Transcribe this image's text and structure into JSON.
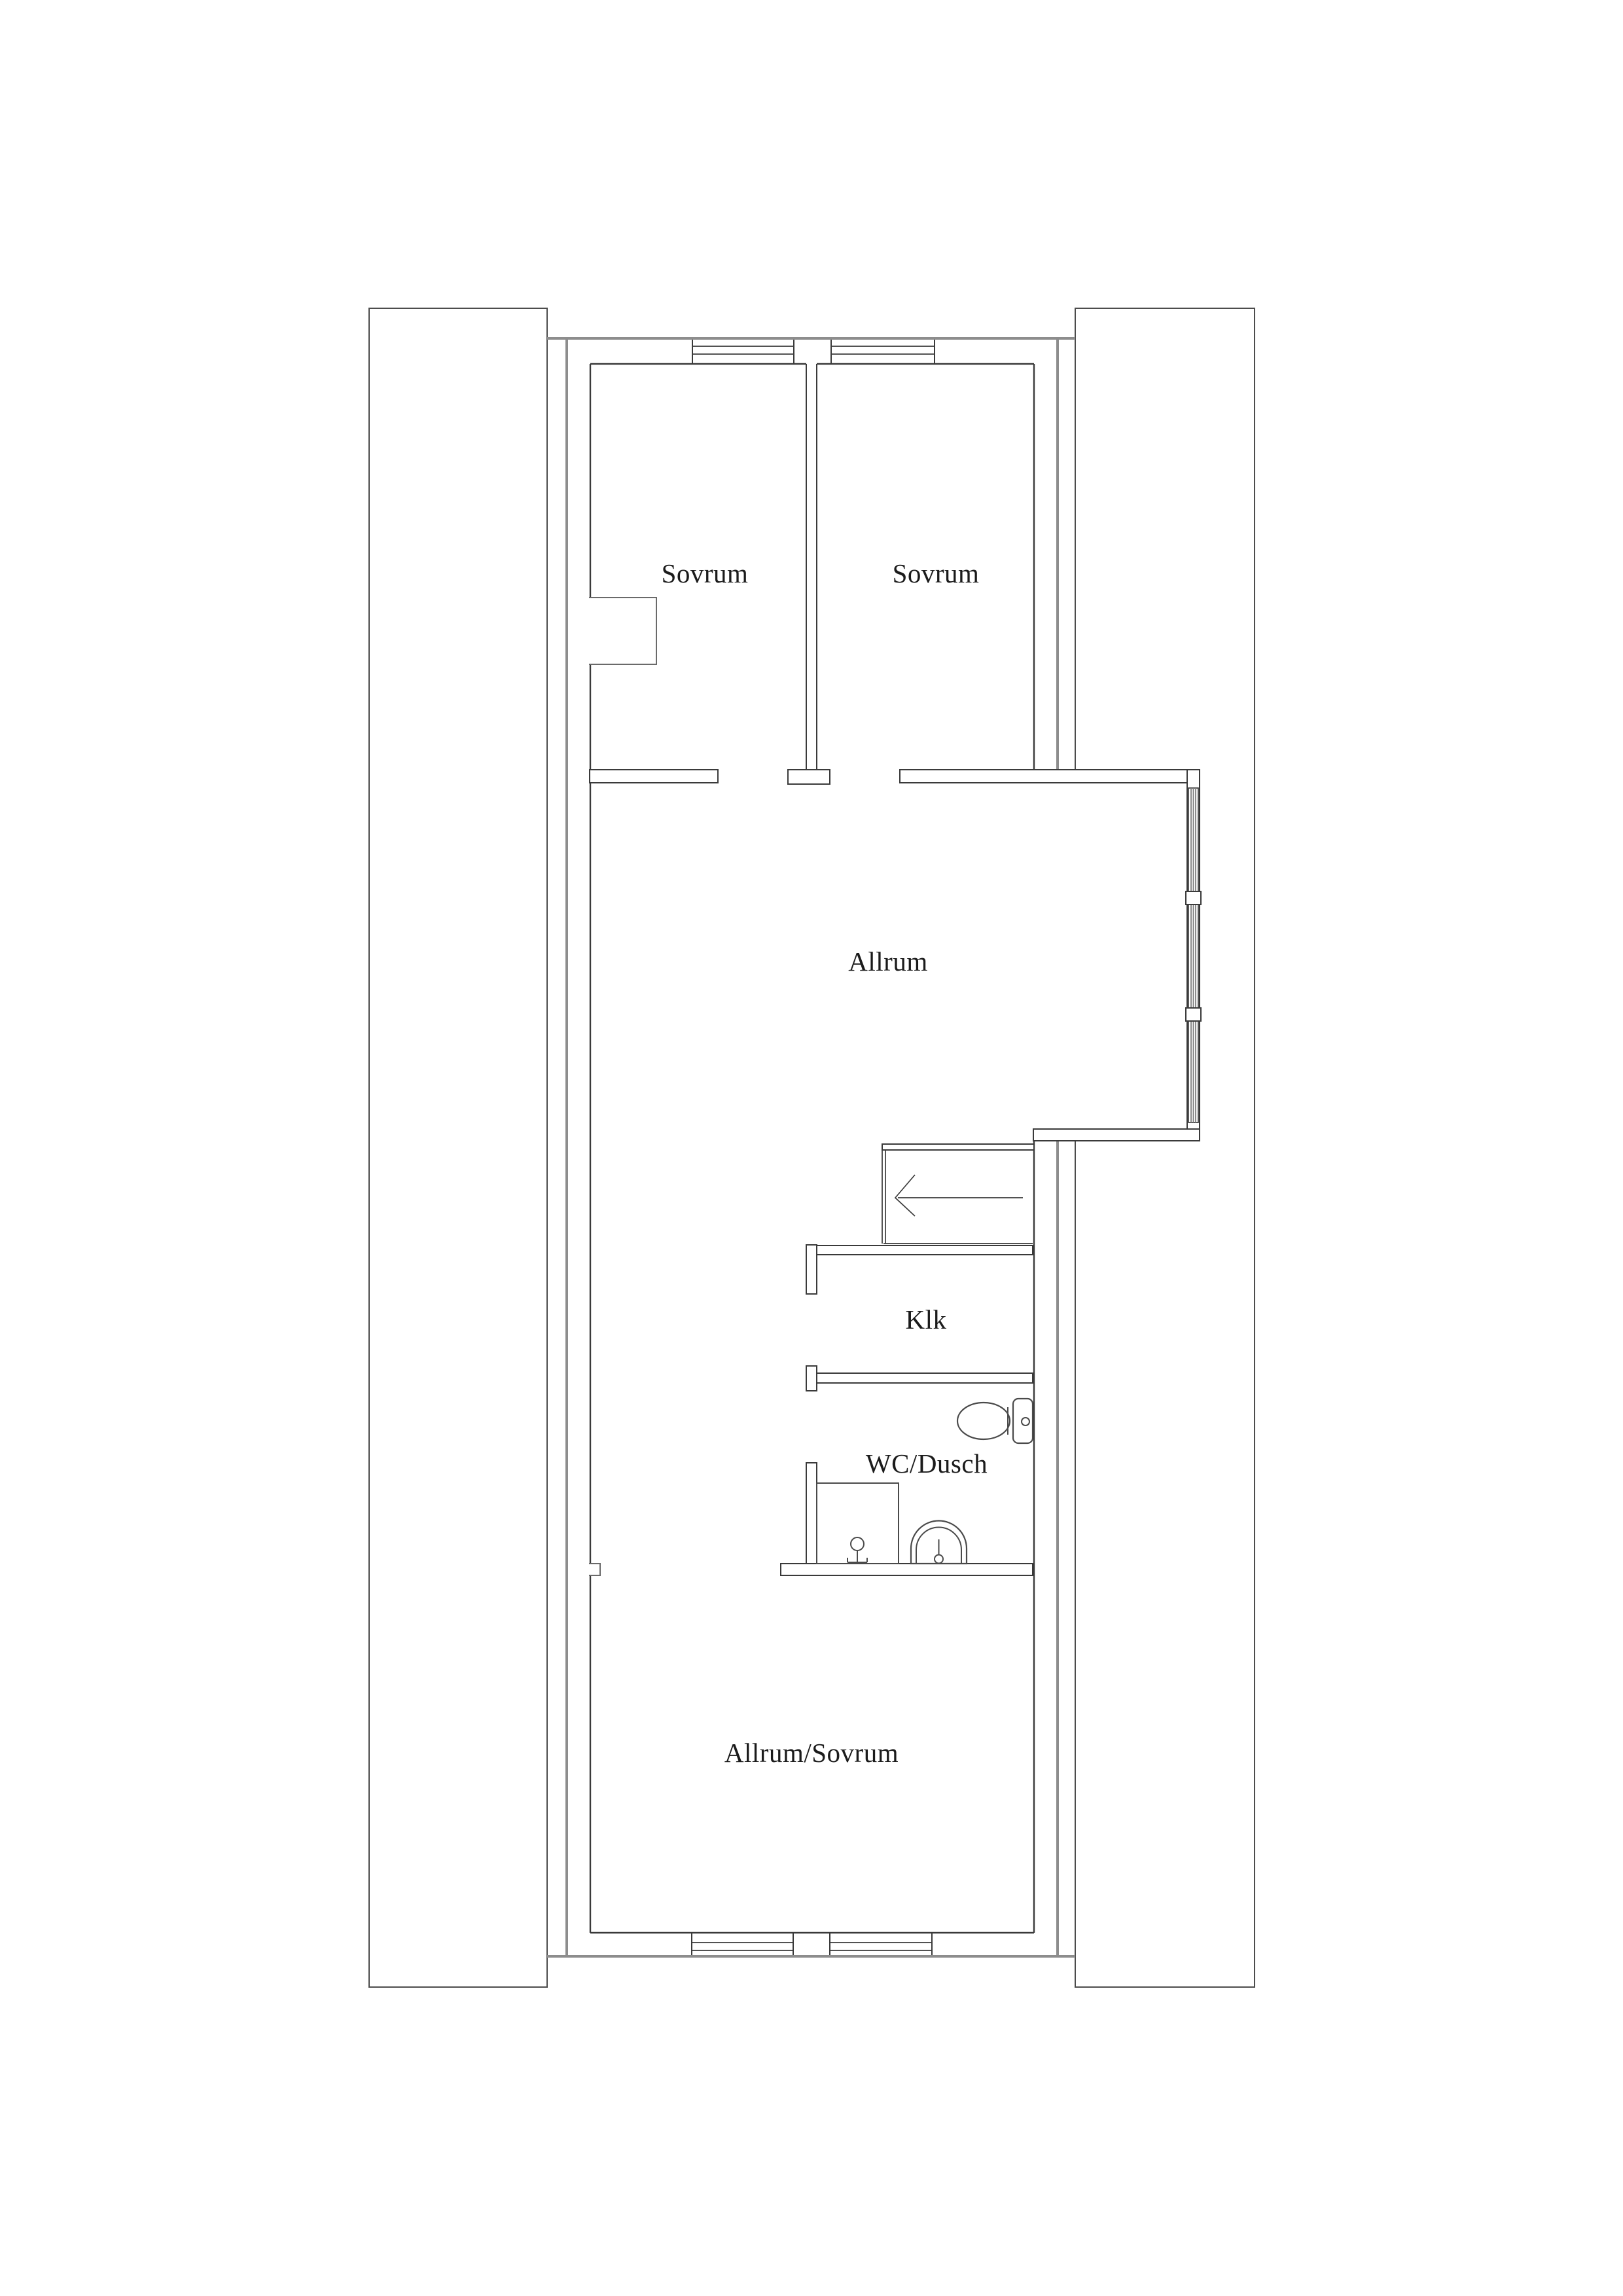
{
  "document": {
    "type": "architectural-floor-plan",
    "language": "sv",
    "background_color": "#ffffff",
    "wall_line_color": "#3a3a3a",
    "exterior_line_color": "#8d8d8d",
    "text_color": "#1b1b1b"
  },
  "rooms": [
    {
      "id": "sovrum-1",
      "label": "Sovrum"
    },
    {
      "id": "sovrum-2",
      "label": "Sovrum"
    },
    {
      "id": "allrum",
      "label": "Allrum"
    },
    {
      "id": "klk",
      "label": "Klk"
    },
    {
      "id": "wc-dusch",
      "label": "WC/Dusch"
    },
    {
      "id": "allrum-sovrum",
      "label": "Allrum/Sovrum"
    }
  ],
  "fixtures": [
    {
      "id": "toilet",
      "room": "wc-dusch"
    },
    {
      "id": "shower",
      "room": "wc-dusch"
    },
    {
      "id": "shower-mixer",
      "room": "wc-dusch"
    },
    {
      "id": "washbasin",
      "room": "wc-dusch"
    }
  ],
  "stair": {
    "direction_arrow": "left"
  },
  "windows": {
    "top_wall": 2,
    "bottom_wall": 2,
    "bay_right_wall": 3
  },
  "side_buildings": {
    "left": 1,
    "right": 1
  }
}
